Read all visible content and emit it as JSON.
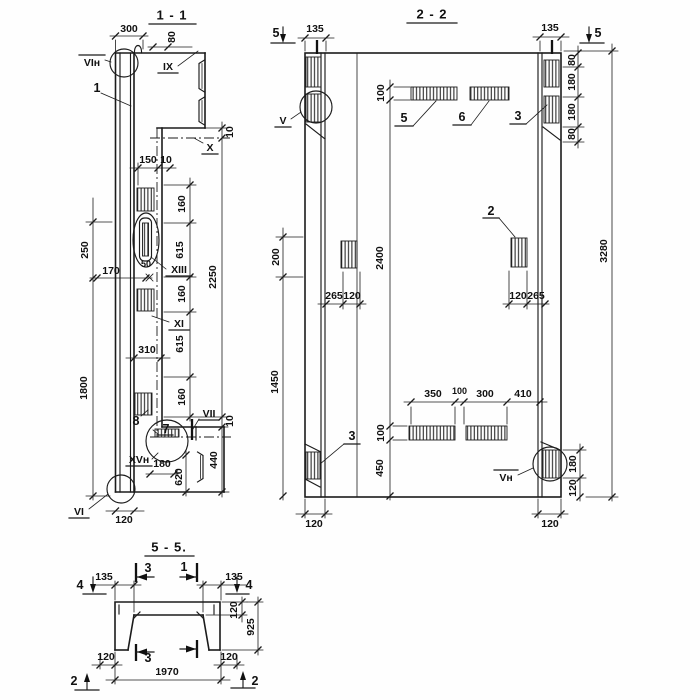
{
  "s11": {
    "title": "1 - 1",
    "items": {
      "n1": "1",
      "n7": "7",
      "n8": "8"
    },
    "marks": {
      "vin": "VIн",
      "ix": "IX",
      "x": "X",
      "xiii": "XIII",
      "xi": "XI",
      "vii": "VII",
      "xvn": "XVн",
      "vi": "VI"
    },
    "dims": {
      "d300": "300",
      "d80": "80",
      "d10t": "10",
      "d150": "150",
      "d10s": "10",
      "d160a": "160",
      "d615a": "615",
      "d160b": "160",
      "d615b": "615",
      "d160c": "160",
      "d2250": "2250",
      "d10b": "10",
      "d440": "440",
      "d250": "250",
      "d1800": "1800",
      "d170": "170",
      "d50": "50",
      "d310": "310",
      "d180": "180",
      "d620": "620",
      "d120": "120"
    }
  },
  "s22": {
    "title": "2 - 2",
    "items": {
      "n2": "2",
      "n3l": "3",
      "n3r": "3",
      "n5": "5",
      "n6": "6"
    },
    "marks": {
      "v": "V",
      "vn": "Vн",
      "cut5l": "5",
      "cut5r": "5"
    },
    "dims": {
      "d135l": "135",
      "d135r": "135",
      "d100t": "100",
      "d2400": "2400",
      "d100b": "100",
      "d450": "450",
      "d200": "200",
      "d1450": "1450",
      "d265l": "265",
      "d120l": "120",
      "d120r": "120",
      "d265r": "265",
      "d350": "350",
      "d100m": "100",
      "d300": "300",
      "d410": "410",
      "d80a": "80",
      "d180a": "180",
      "d180b": "180",
      "d80b": "80",
      "d180c": "180",
      "d120c": "120",
      "d3280": "3280",
      "d120bl": "120",
      "d120br": "120"
    }
  },
  "s55": {
    "title": "5 - 5.",
    "marks": {
      "cut4l": "4",
      "cut4r": "4",
      "cut2l": "2",
      "cut2r": "2",
      "cut3t": "3",
      "cut1t": "1",
      "cut3b": "3"
    },
    "dims": {
      "d135l": "135",
      "d135r": "135",
      "d120t": "120",
      "d925": "925",
      "d120bl": "120",
      "d120br": "120",
      "d1970": "1970"
    }
  }
}
